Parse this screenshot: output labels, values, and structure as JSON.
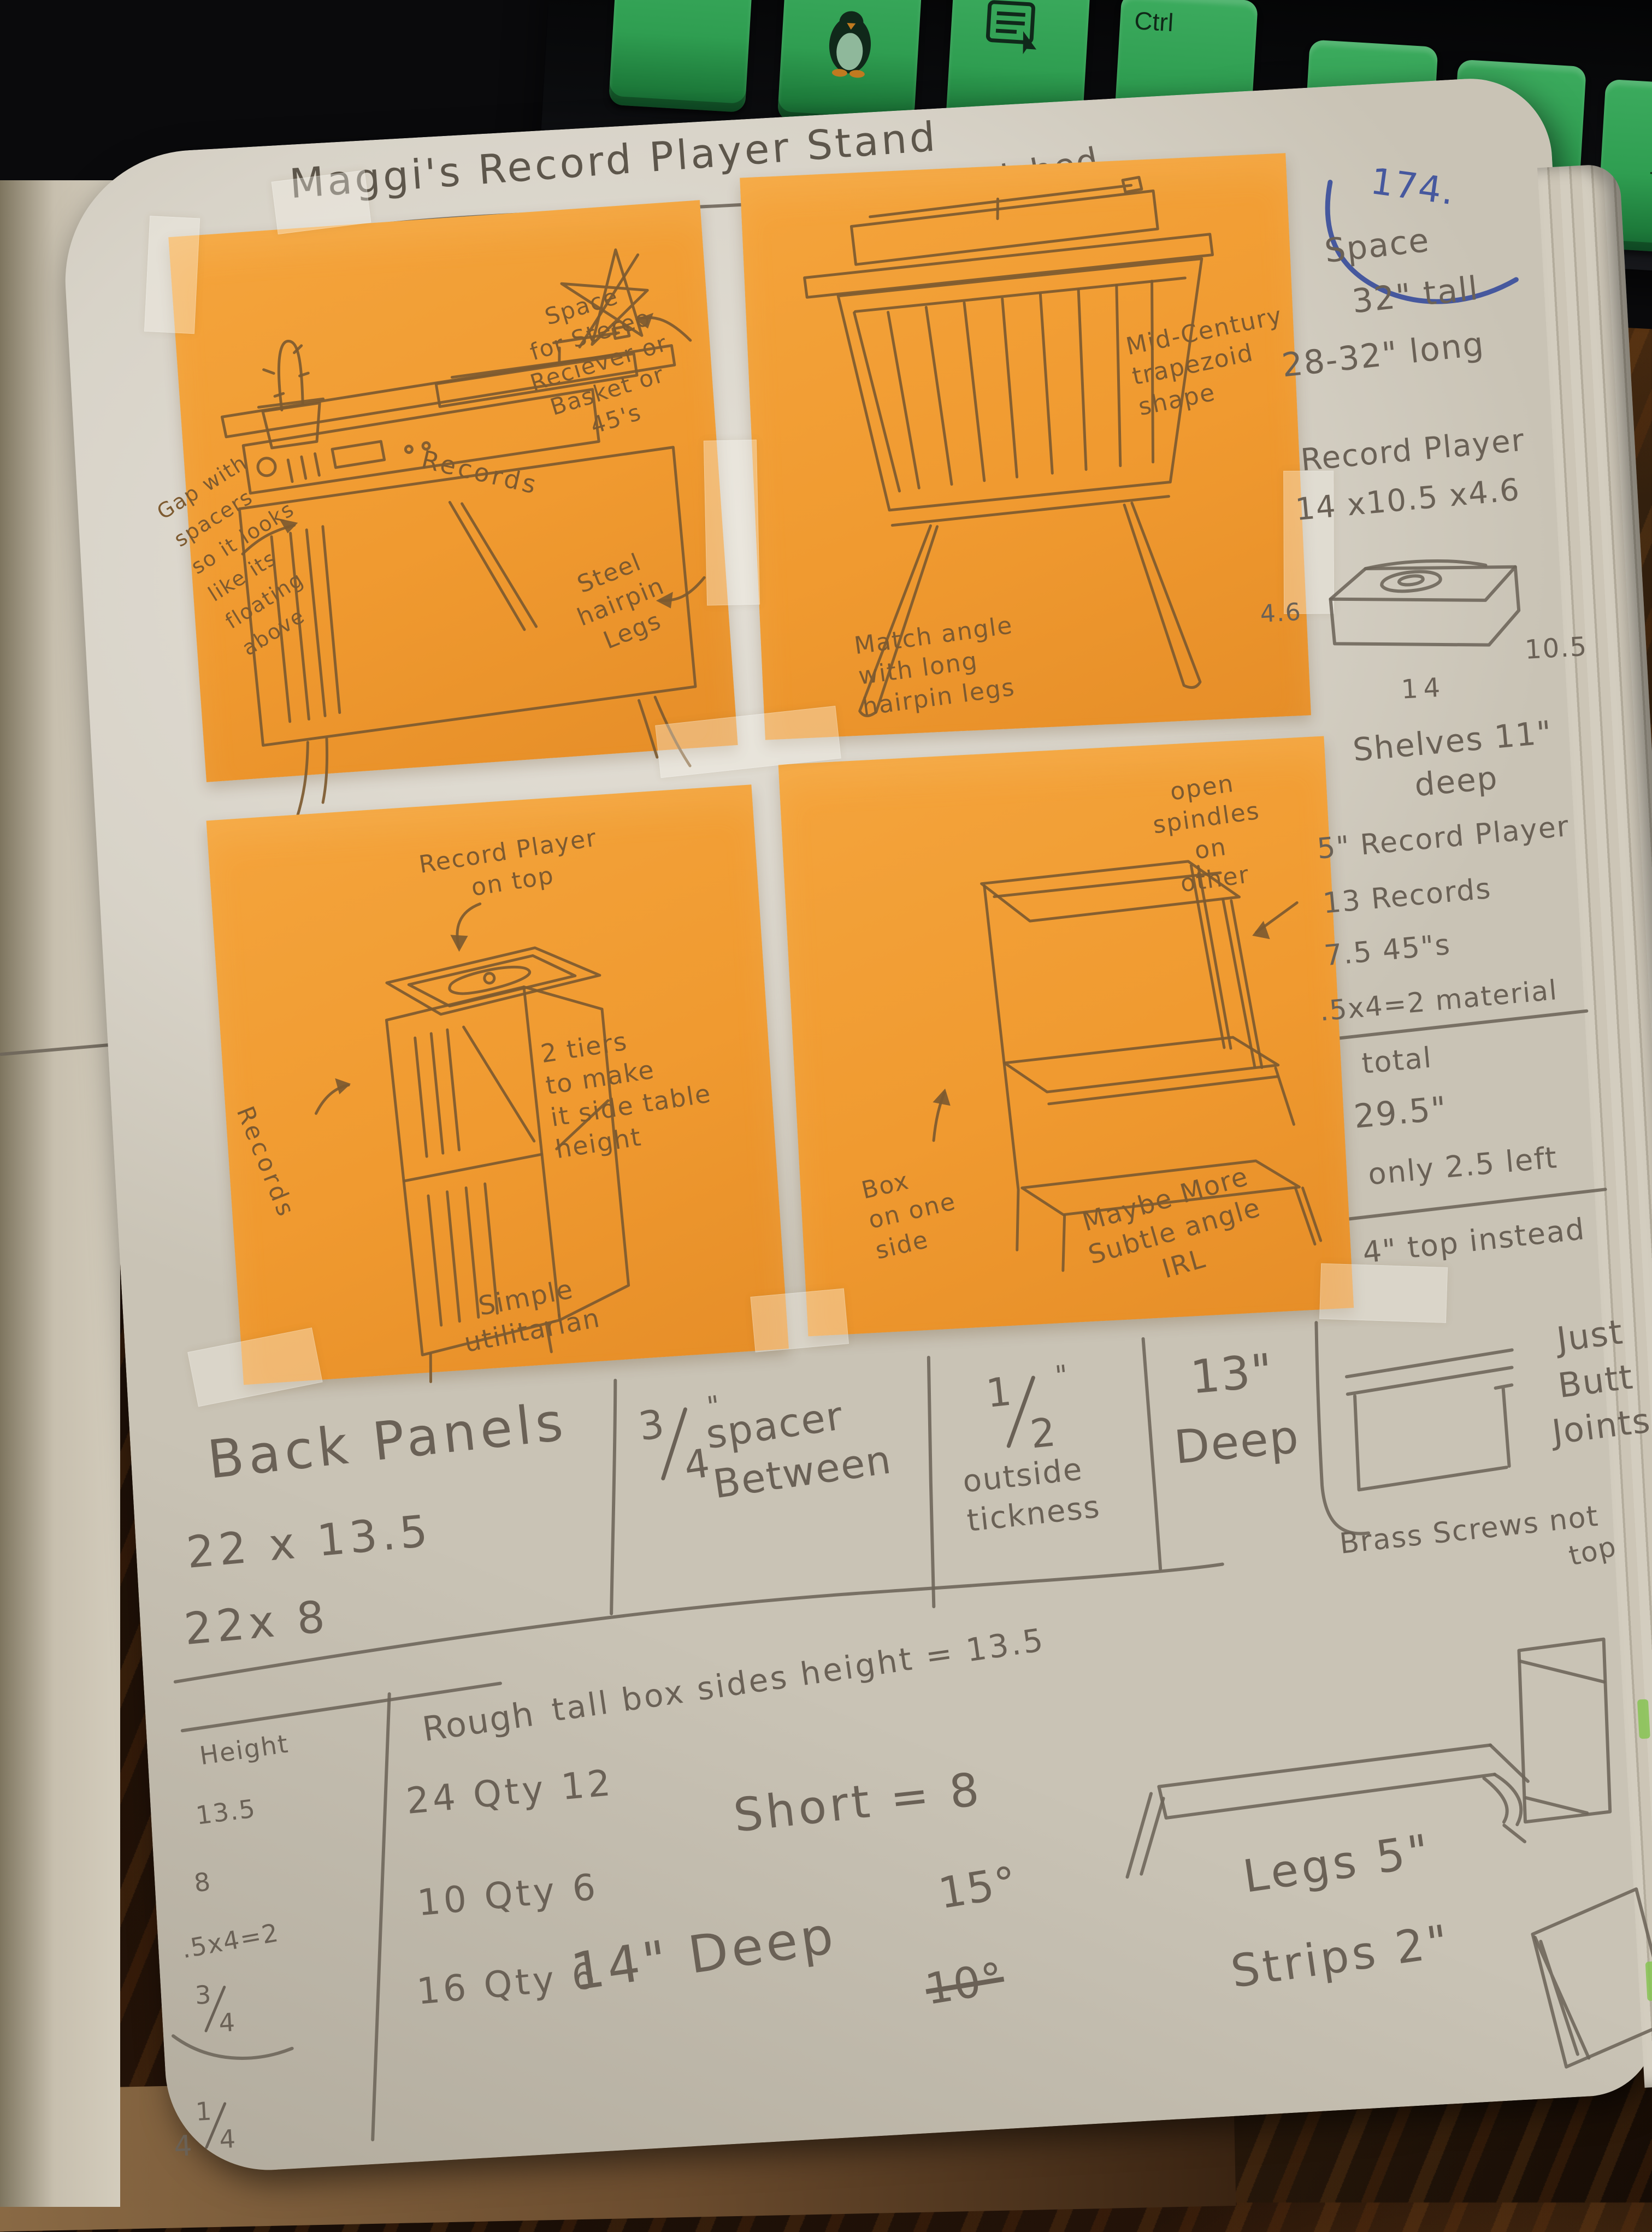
{
  "colors": {
    "sticky_orange": "#F09A30",
    "page_cream": "#D8D3C8",
    "keyboard_green": "#2F9E51",
    "desk_brown": "#33200E",
    "pencil_gray": "#6A6156",
    "pencil_brown": "#7D5A30",
    "pen_blue": "#46589E",
    "highlighter_green": "#86C352"
  },
  "keyboard": {
    "keys": [
      {
        "label": "Alt"
      },
      {
        "label": "",
        "icon": "tux-icon"
      },
      {
        "label": "Fn",
        "icon": "menu-icon"
      },
      {
        "label": "Ctrl"
      },
      {
        "label": "←"
      },
      {
        "label": "↓"
      },
      {
        "label": "→"
      }
    ]
  },
  "header": {
    "title": "Maggi's Record Player Stand",
    "finished_label": "Finished",
    "finished_date": "5-18-20",
    "page_number": "174."
  },
  "sticky_top_left": {
    "annotation_space": "Space\nfor Stereo\nReciever or\nBasket or\n45's",
    "annotation_legs": "Steel\nhairpin\nLegs",
    "annotation_gap": "Gap with\nspacers\nso it looks\nlike its\nfloating\nabove",
    "records_label": "Records"
  },
  "sticky_top_right": {
    "annotation_shape": "Mid-Century\ntrapezoid\nshape",
    "annotation_angle": "Match angle\nwith long\nhairpin legs"
  },
  "sticky_bottom_left": {
    "annotation_player": "Record Player\non top",
    "annotation_tiers": "2 tiers\nto make\nit side table\nheight",
    "annotation_simple": "Simple\nutilitarian",
    "records_label": "Records"
  },
  "sticky_bottom_right": {
    "annotation_spindles": "open\nspindles\non\nother",
    "annotation_box": "Box\non one\nside",
    "annotation_angle": "Maybe More\nSubtle angle\nIRL"
  },
  "margin_notes": {
    "space": "Space",
    "tall": "32\" tall",
    "long": "28-32\" long",
    "record_player": "Record Player",
    "rp_dims": "14 x10.5 x4.6",
    "rp_h": "4.6",
    "rp_d": "10.5",
    "rp_w": "14",
    "shelves": "Shelves 11\"\ndeep",
    "rp5": "5\" Record Player",
    "records13": "13 Records",
    "fortyfives": "7.5 45\"s",
    "material": ".5x4=2 material",
    "total_label": "total",
    "total_value": "29.5\"",
    "left_note": "only 2.5 left",
    "top_note": "4\" top instead"
  },
  "bottom_notes": {
    "back_panels": "Back Panels",
    "panel1": "22 x 13.5",
    "panel2": "22x 8",
    "spacer_num": "3",
    "spacer_den": "4",
    "spacer_unit": "\"",
    "spacer_text": "spacer\nBetween",
    "outside_num": "1",
    "outside_den": "2",
    "outside_unit": "\"",
    "outside_text": "outside\ntickness",
    "deep_value": "13\"",
    "deep_word": "Deep",
    "butt_joint": "Just\nButt\nJoints",
    "brass": "Brass Screws not",
    "brass_top": "top"
  },
  "cut_table": {
    "height_label": "Height",
    "heights": [
      "13.5",
      "8",
      ".5x4=2"
    ],
    "height_frac": {
      "num": "3",
      "den": "4"
    },
    "height_last": {
      "whole": "4",
      "num": "1",
      "den": "4"
    },
    "rough_label": "Rough",
    "rough_rows": [
      "24 Qty 12",
      "10 Qty 6",
      "16 Qty 6"
    ]
  },
  "calc_notes": {
    "tall_box": "tall box sides height = 13.5",
    "short": "Short  = 8",
    "deep": "14\" Deep",
    "angle1": "15°",
    "angle2": "10°",
    "legs": "Legs 5\"",
    "strips": "Strips 2\""
  }
}
